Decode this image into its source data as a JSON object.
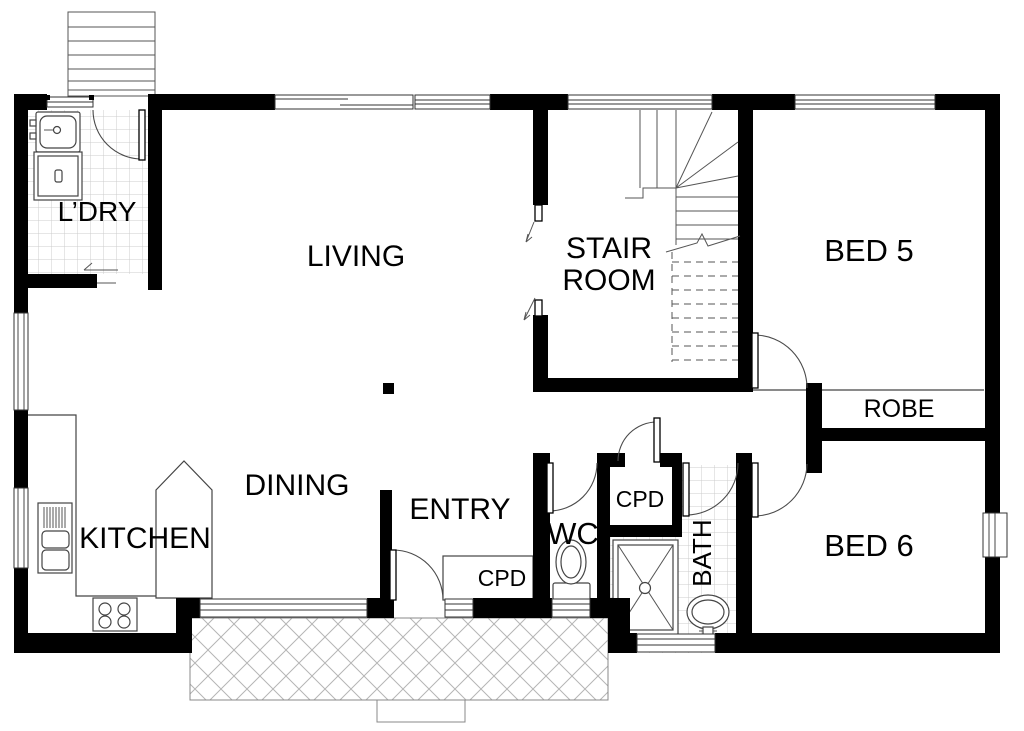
{
  "rooms": {
    "ldry": "L’DRY",
    "living": "LIVING",
    "stair1": "STAIR",
    "stair2": "ROOM",
    "bed5": "BED 5",
    "robe": "ROBE",
    "bed6": "BED 6",
    "bath": "BATH",
    "wc": "WC",
    "cpd_hall": "CPD",
    "cpd_entry": "CPD",
    "entry": "ENTRY",
    "dining": "DINING",
    "kitchen": "KITCHEN"
  },
  "colors": {
    "wall": "#000000",
    "line": "#444444",
    "tile": "#cccccc",
    "hatch": "#b5b5b5",
    "background": "#ffffff"
  }
}
